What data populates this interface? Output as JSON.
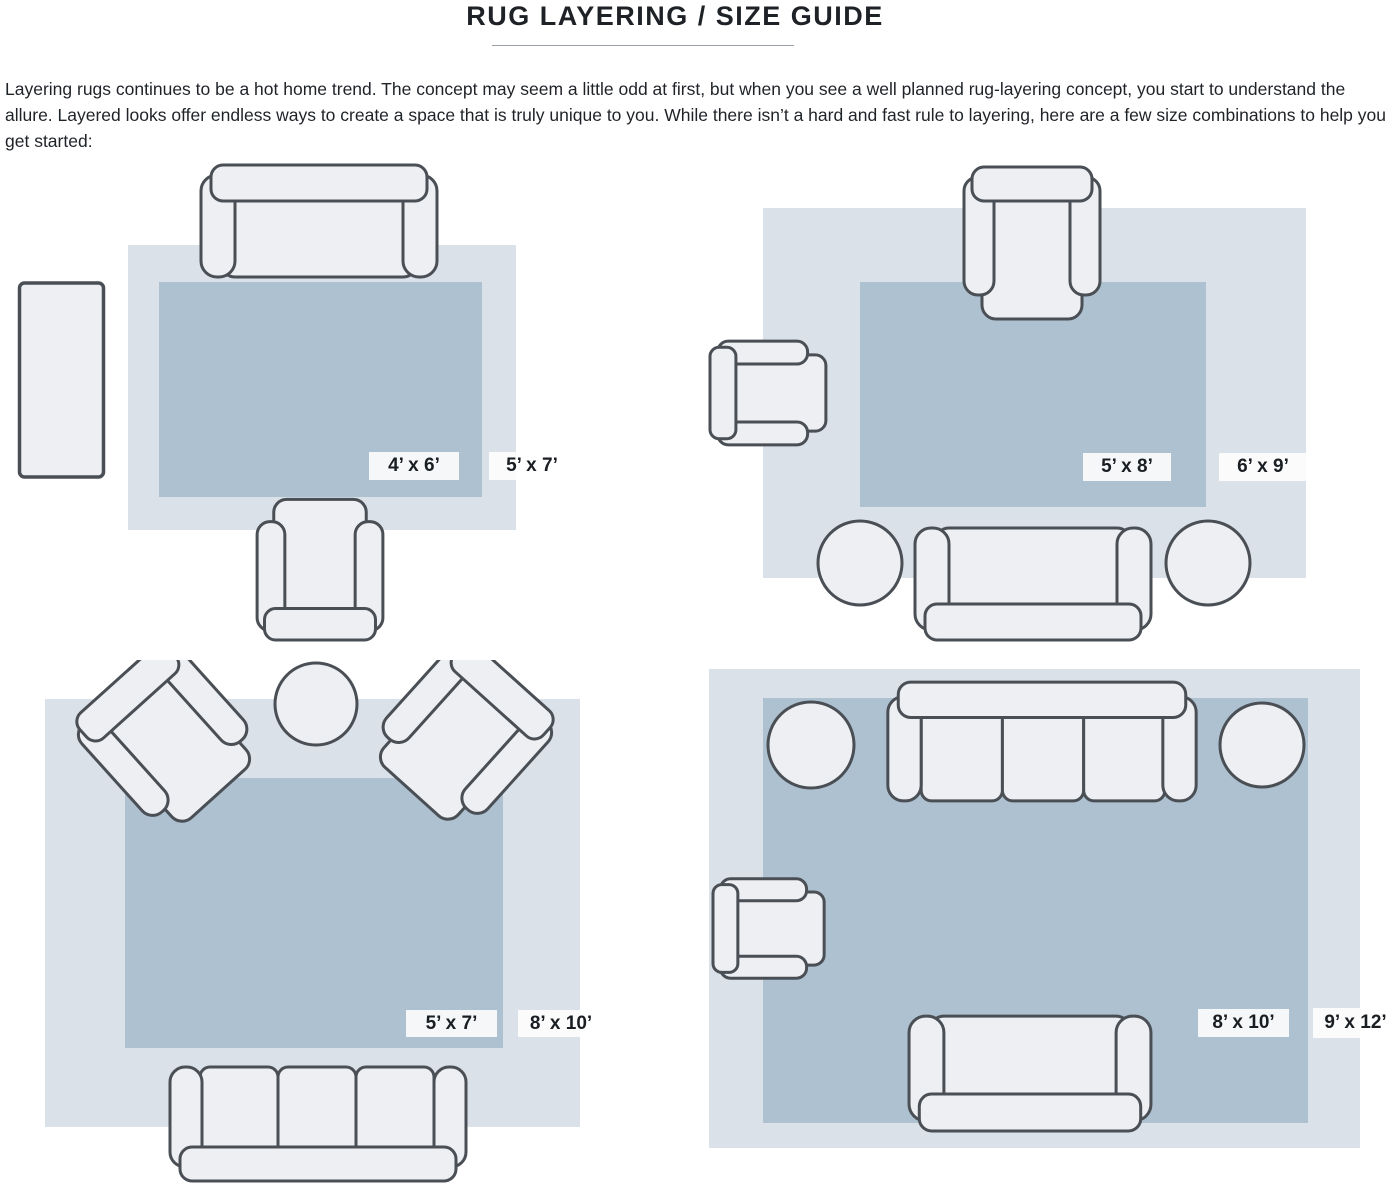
{
  "page": {
    "title": "RUG LAYERING / SIZE GUIDE",
    "intro": "Layering rugs continues to be a hot home trend. The concept may seem a little odd at first, but when you see a well planned rug-layering concept, you start to understand the allure. Layered looks offer endless ways to create a space that is truly unique to you. While there isn’t a hard and fast rule to layering, here are a few size combinations to help you get started:"
  },
  "colors": {
    "outer_rug": "#dbe1e9",
    "inner_rug": "#aec1d0",
    "furniture_fill": "#edeff2",
    "furniture_outline": "#4a4f55",
    "label_background": "#ffffff",
    "label_text": "#1a1e23"
  },
  "layouts": [
    {
      "name": "layout-1",
      "inner_rug_size": "4’ x 6’",
      "outer_rug_size": "5’ x 7’"
    },
    {
      "name": "layout-2",
      "inner_rug_size": "5’ x 8’",
      "outer_rug_size": "6’ x 9’"
    },
    {
      "name": "layout-3",
      "inner_rug_size": "5’ x 7’",
      "outer_rug_size": "8’ x 10’"
    },
    {
      "name": "layout-4",
      "inner_rug_size": "8’ x 10’",
      "outer_rug_size": "9’ x 12’"
    }
  ]
}
